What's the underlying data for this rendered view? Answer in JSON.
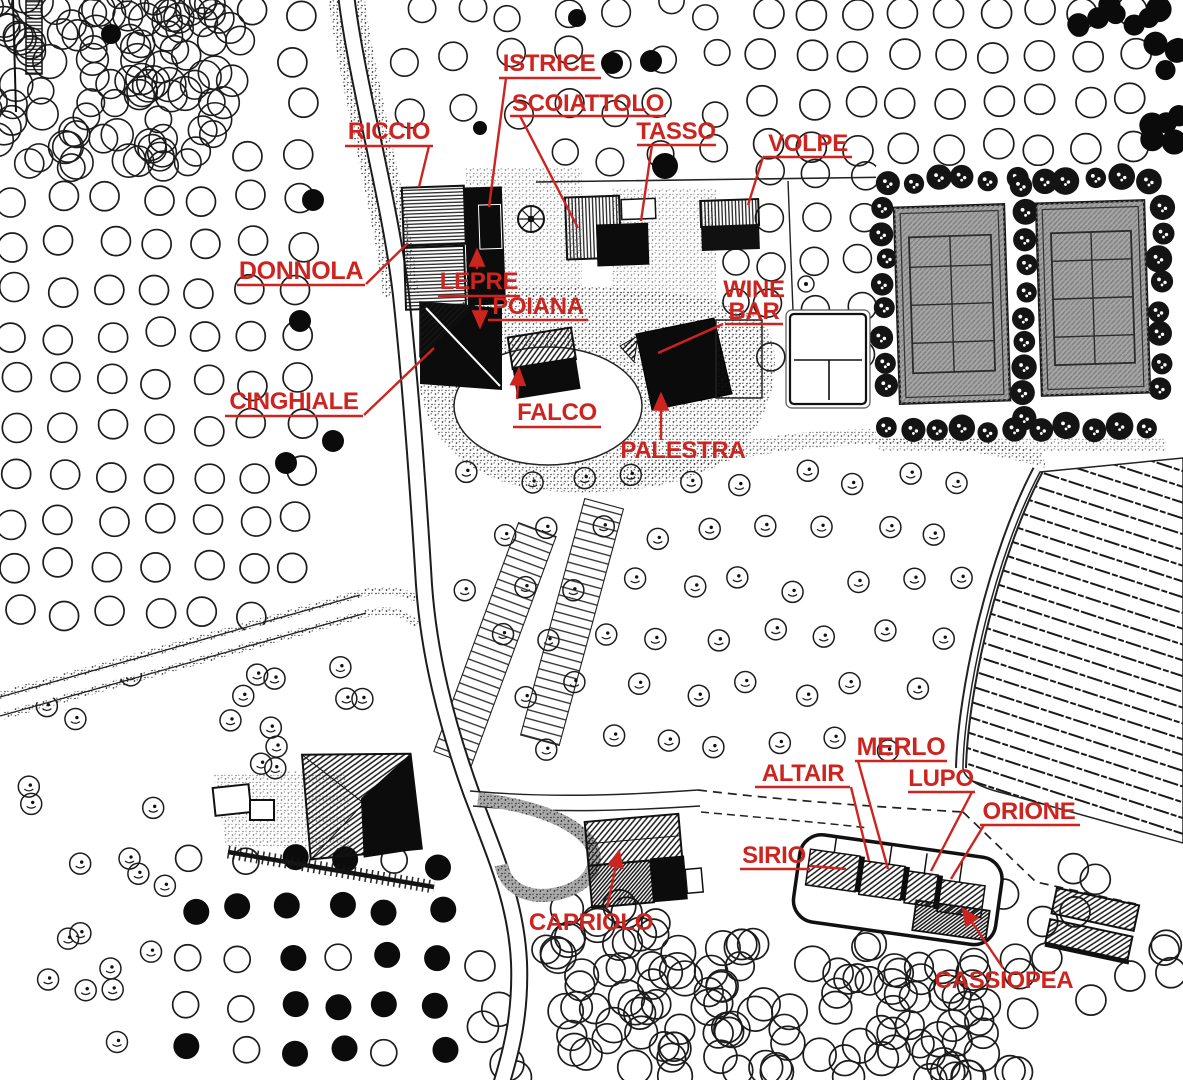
{
  "map": {
    "kind": "resort-site-plan",
    "colors": {
      "label": "#ce2420",
      "ink": "#1a1a1a",
      "paper": "#ffffff",
      "court": "#a6a6a6"
    },
    "labels": [
      {
        "id": "riccio",
        "text": "RICCIO",
        "x": 389,
        "y": 139,
        "fs": 24,
        "u": [
          345,
          433,
          146
        ],
        "leader": [
          [
            429,
            146
          ],
          [
            419,
            187
          ]
        ],
        "arrow": false
      },
      {
        "id": "istrice",
        "text": "ISTRICE",
        "x": 549,
        "y": 71,
        "fs": 24,
        "u": [
          499,
          601,
          78
        ],
        "leader": [
          [
            506,
            78
          ],
          [
            489,
            207
          ]
        ],
        "arrow": false
      },
      {
        "id": "scoiattolo",
        "text": "SCOIATTOLO",
        "x": 588,
        "y": 111,
        "fs": 24,
        "u": [
          510,
          666,
          116
        ],
        "leader": [
          [
            520,
            116
          ],
          [
            578,
            228
          ]
        ],
        "arrow": false
      },
      {
        "id": "tasso",
        "text": "TASSO",
        "x": 676,
        "y": 139,
        "fs": 24,
        "u": [
          637,
          716,
          145
        ],
        "leader": [
          [
            652,
            145
          ],
          [
            641,
            221
          ]
        ],
        "arrow": false
      },
      {
        "id": "volpe",
        "text": "VOLPE",
        "x": 808,
        "y": 151,
        "fs": 24,
        "u": [
          763,
          852,
          157
        ],
        "leader": [
          [
            763,
            157
          ],
          [
            748,
            205
          ]
        ],
        "arrow": false
      },
      {
        "id": "donnola",
        "text": "DONNOLA",
        "x": 301,
        "y": 279,
        "fs": 25,
        "u": [
          237,
          365,
          285
        ],
        "leader": [
          [
            366,
            284
          ],
          [
            408,
            243
          ]
        ],
        "arrow": false
      },
      {
        "id": "lepre",
        "text": "LEPRE",
        "x": 479,
        "y": 289,
        "fs": 24,
        "u": [
          438,
          520,
          296
        ],
        "leader": [
          [
            477,
            269
          ],
          [
            477,
            250
          ]
        ],
        "arrow": true
      },
      {
        "id": "poiana",
        "text": "POIANA",
        "x": 538,
        "y": 314,
        "fs": 24,
        "u": [
          488,
          588,
          320
        ],
        "leader": [
          [
            480,
            298
          ],
          [
            480,
            327
          ]
        ],
        "arrow": true
      },
      {
        "id": "cinghiale",
        "text": "CINGHIALE",
        "x": 294,
        "y": 409,
        "fs": 24,
        "u": [
          225,
          363,
          416
        ],
        "leader": [
          [
            364,
            415
          ],
          [
            434,
            348
          ]
        ],
        "arrow": false
      },
      {
        "id": "falco",
        "text": "FALCO",
        "x": 557,
        "y": 420,
        "fs": 24,
        "u": [
          513,
          601,
          427
        ],
        "leader": [
          [
            517,
            399
          ],
          [
            519,
            369
          ]
        ],
        "arrow": true
      },
      {
        "id": "wine-bar",
        "lines": [
          "WINE",
          "BAR"
        ],
        "x": 754,
        "y": 297,
        "lh": 22,
        "fs": 24,
        "u": [
          725,
          783,
          324
        ],
        "leader": [
          [
            723,
            324
          ],
          [
            658,
            353
          ]
        ],
        "arrow": false
      },
      {
        "id": "palestra",
        "text": "PALESTRA",
        "x": 683,
        "y": 458,
        "fs": 24,
        "u": null,
        "leader": [
          [
            661,
            440
          ],
          [
            661,
            394
          ]
        ],
        "arrow": true
      },
      {
        "id": "capriolo",
        "text": "CAPRIOLO",
        "x": 591,
        "y": 930,
        "fs": 24,
        "u": null,
        "leader": [
          [
            607,
            908
          ],
          [
            619,
            851
          ]
        ],
        "arrow": true
      },
      {
        "id": "merlo",
        "text": "MERLO",
        "x": 901,
        "y": 755,
        "fs": 25,
        "u": [
          855,
          947,
          761
        ],
        "leader": [
          [
            858,
            761
          ],
          [
            888,
            869
          ]
        ],
        "arrow": false
      },
      {
        "id": "altair",
        "text": "ALTAIR",
        "x": 803,
        "y": 781,
        "fs": 24,
        "u": [
          755,
          850,
          787
        ],
        "leader": [
          [
            851,
            787
          ],
          [
            869,
            861
          ]
        ],
        "arrow": false
      },
      {
        "id": "lupo",
        "text": "LUPO",
        "x": 941,
        "y": 786,
        "fs": 24,
        "u": [
          908,
          975,
          792
        ],
        "leader": [
          [
            972,
            792
          ],
          [
            931,
            871
          ]
        ],
        "arrow": false
      },
      {
        "id": "orione",
        "text": "ORIONE",
        "x": 1029,
        "y": 819,
        "fs": 24,
        "u": [
          980,
          1080,
          825
        ],
        "leader": [
          [
            984,
            825
          ],
          [
            951,
            879
          ]
        ],
        "arrow": false
      },
      {
        "id": "sirio",
        "text": "SIRIO",
        "x": 774,
        "y": 863,
        "fs": 24,
        "u": [
          740,
          810,
          869
        ],
        "leader": [
          [
            810,
            866
          ],
          [
            846,
            869
          ]
        ],
        "arrow": false
      },
      {
        "id": "cassiopea",
        "text": "CASSIOPEA",
        "x": 1004,
        "y": 988,
        "fs": 24,
        "u": null,
        "leader": [
          [
            1003,
            968
          ],
          [
            963,
            909
          ]
        ],
        "arrow": true
      }
    ]
  }
}
